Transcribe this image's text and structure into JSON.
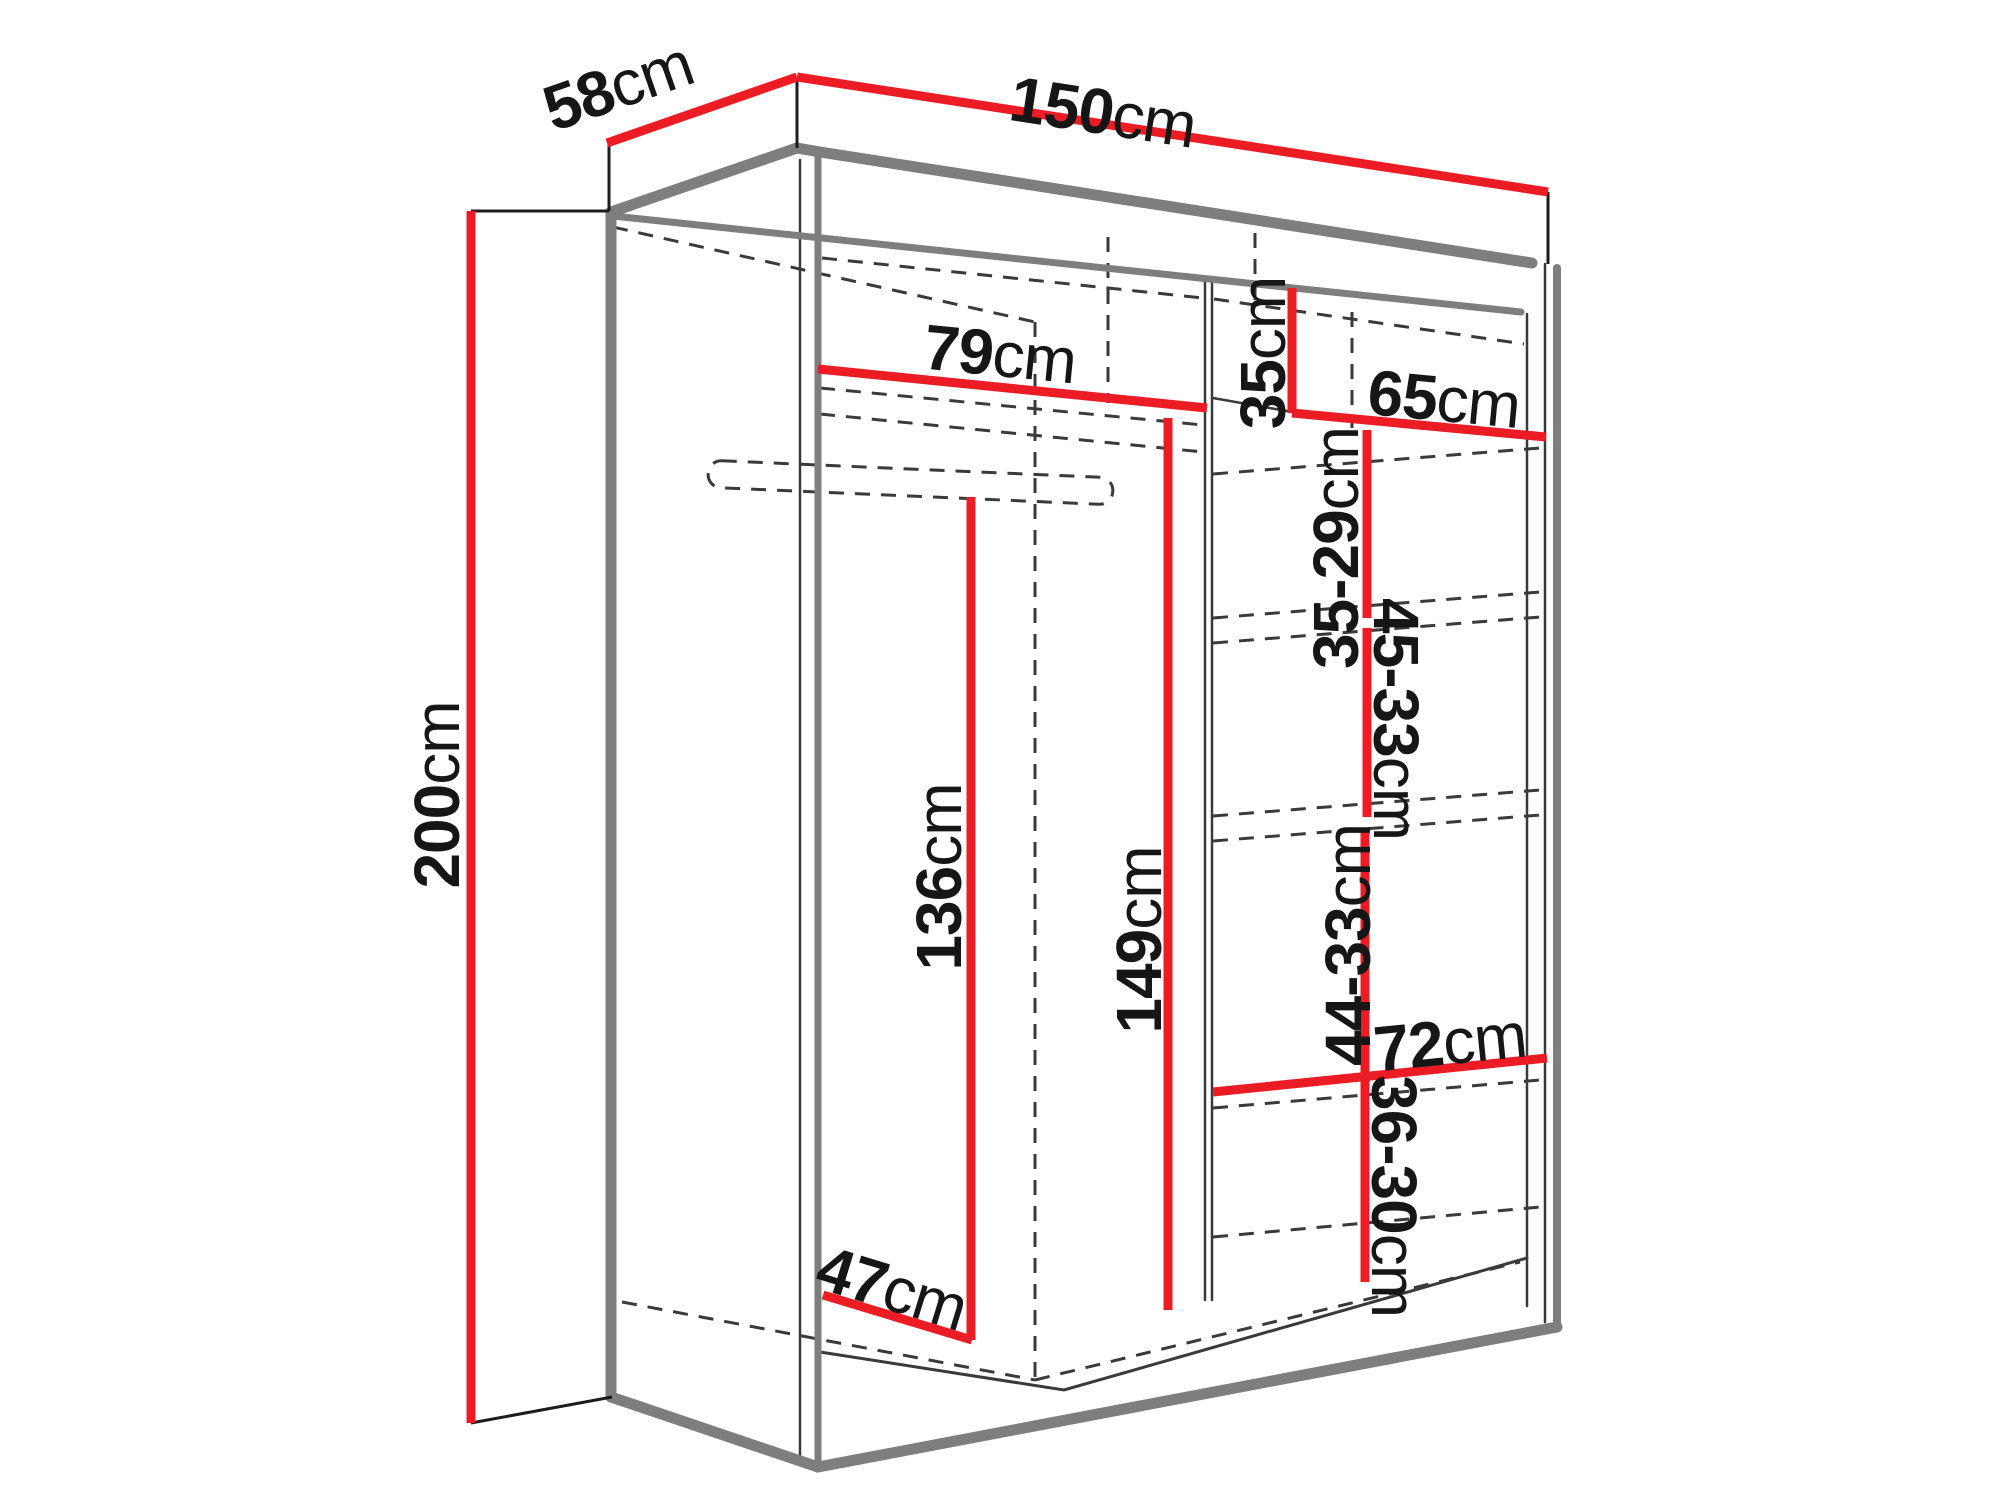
{
  "page": {
    "background": "#ffffff"
  },
  "colors": {
    "dimension": "#ec1c24",
    "structure": "#7e7e7e",
    "edge": "#3a3a3a",
    "tick": "#1c1c1c",
    "text": "#161616"
  },
  "diagram": {
    "type": "furniture-dimension-diagram",
    "subject": "sliding-door wardrobe interior dimensions, perspective line drawing",
    "unit": "cm",
    "labels": {
      "width": {
        "value": "150",
        "unit": "cm"
      },
      "depth": {
        "value": "58",
        "unit": "cm"
      },
      "height": {
        "value": "200",
        "unit": "cm"
      },
      "left_top_shelf_width": {
        "value": "79",
        "unit": "cm"
      },
      "right_top_shelf_height": {
        "value": "35",
        "unit": "cm"
      },
      "right_section_width": {
        "value": "65",
        "unit": "cm"
      },
      "right_gap_1": {
        "value": "35-29",
        "unit": "cm"
      },
      "right_gap_2": {
        "value": "45-33",
        "unit": "cm"
      },
      "right_gap_3": {
        "value": "44-33",
        "unit": "cm"
      },
      "right_bottom_shelf_width": {
        "value": "72",
        "unit": "cm"
      },
      "right_gap_4": {
        "value": "36-30",
        "unit": "cm"
      },
      "hanging_space_height": {
        "value": "136",
        "unit": "cm"
      },
      "left_section_height": {
        "value": "149",
        "unit": "cm"
      },
      "floor_depth": {
        "value": "47",
        "unit": "cm"
      }
    }
  }
}
